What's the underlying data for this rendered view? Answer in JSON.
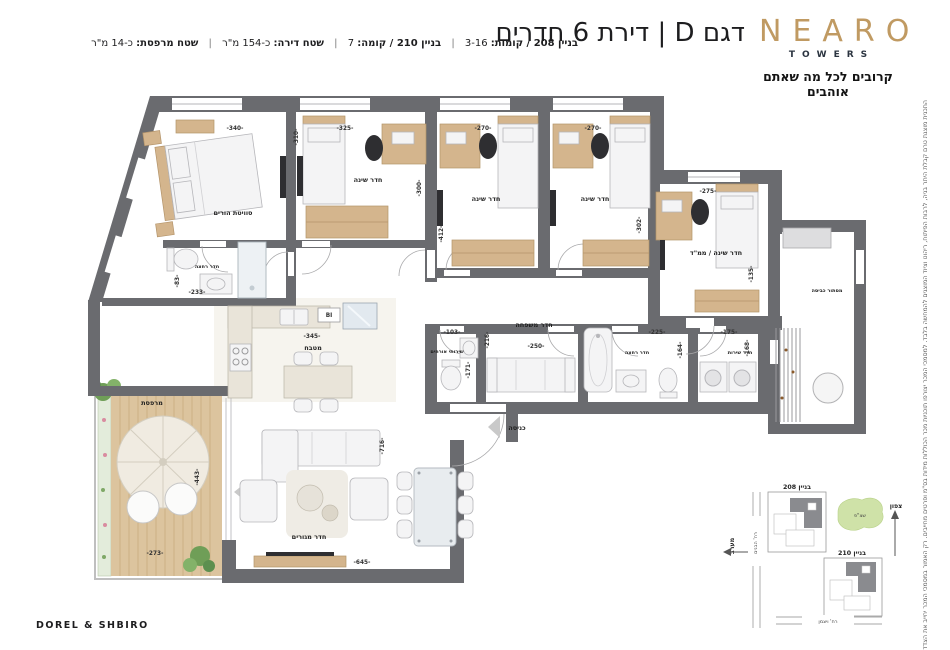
{
  "brand": {
    "logo": "NEARO",
    "sub": "TOWERS",
    "tagline": "קרובים לכל מה שאתם אוהבים"
  },
  "header": {
    "title": "דגם D | דירת 6 חדרים",
    "sep": "|",
    "info": [
      {
        "label": "בניין 208 / קומות:",
        "value": "3-16"
      },
      {
        "label": "בניין 210 / קומה:",
        "value": "7"
      },
      {
        "label": "שטח דירה:",
        "value": "כ-154 מ\"ר"
      },
      {
        "label": "שטח מרפסת:",
        "value": "כ-14 מ\"ר"
      }
    ]
  },
  "disclaimer": "התכנית מוצגת טרם קבלת היתר בניה, לרבות הפיתוח, ריהוט וציוד המוצגים להמחשה בלבד. למסמכי המכר יצורפו תוכניות מכר הכוללות מידות בס\"מ ופרטים מחייבים. רק האמור במסמכי המכר יחייב את הצדדים.",
  "credit": "DOREL & SHBIRO",
  "plan": {
    "rooms": [
      "סוויטת הורים",
      "חדר שינה",
      "חדר שינה",
      "חדר שינה",
      "חדר שינה / ממ\"ד",
      "מסתור כביסה",
      "חדר רחצה",
      "שירותי אורחים",
      "חדר משפחה",
      "חדר רחצה",
      "חדר שירות",
      "מטבח",
      "חדר מגורים",
      "מרפסת"
    ],
    "entry": "כניסה",
    "builtin": "BI",
    "dims": [
      "-340-",
      "-310-",
      "-325-",
      "-300-",
      "-412-",
      "-270-",
      "-270-",
      "-302-",
      "-275-",
      "-135-",
      "-83-",
      "-233-",
      "-345-",
      "-103-",
      "-216-",
      "-171-",
      "-250-",
      "-225-",
      "-164-",
      "-175-",
      "-168-",
      "-443-",
      "-273-",
      "-645-",
      "-716-"
    ]
  },
  "sitemap": {
    "b208": "בניין 208",
    "b210": "בניין 210",
    "green": "שצ\"פ",
    "north": "צפון",
    "west": "מערב",
    "street_v": "רח' הבנים",
    "street_h": "רח' ויצמן"
  }
}
